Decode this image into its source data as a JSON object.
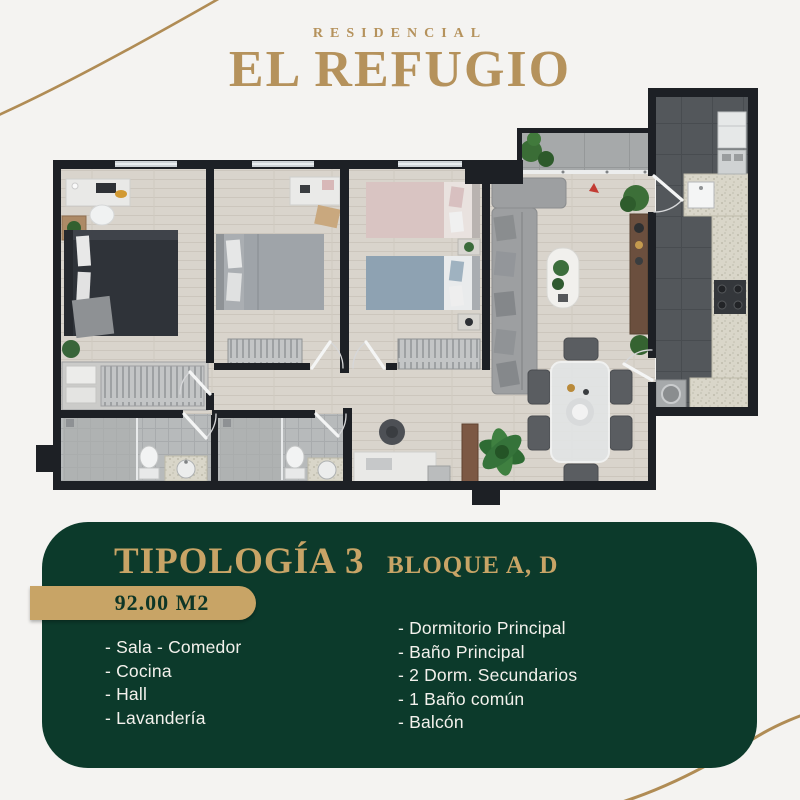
{
  "brand": {
    "kicker": "RESIDENCIAL",
    "name": "EL REFUGIO"
  },
  "card": {
    "title": "TIPOLOGÍA 3",
    "subtitle": "BLOQUE A, D",
    "area_badge": "92.00 M2",
    "features_left": [
      "- Sala - Comedor",
      "- Cocina",
      "- Hall",
      "- Lavandería"
    ],
    "features_right": [
      "- Dormitorio Principal",
      "- Baño Principal",
      "- 2 Dorm. Secundarios",
      "- 1 Baño común",
      "- Balcón"
    ]
  },
  "colors": {
    "gold": "#b5925c",
    "gold_badge": "#c8a466",
    "green": "#0c3a2b",
    "badge_text": "#0e3627",
    "list_text": "#f3f1ec",
    "background": "#f4f3f1"
  }
}
